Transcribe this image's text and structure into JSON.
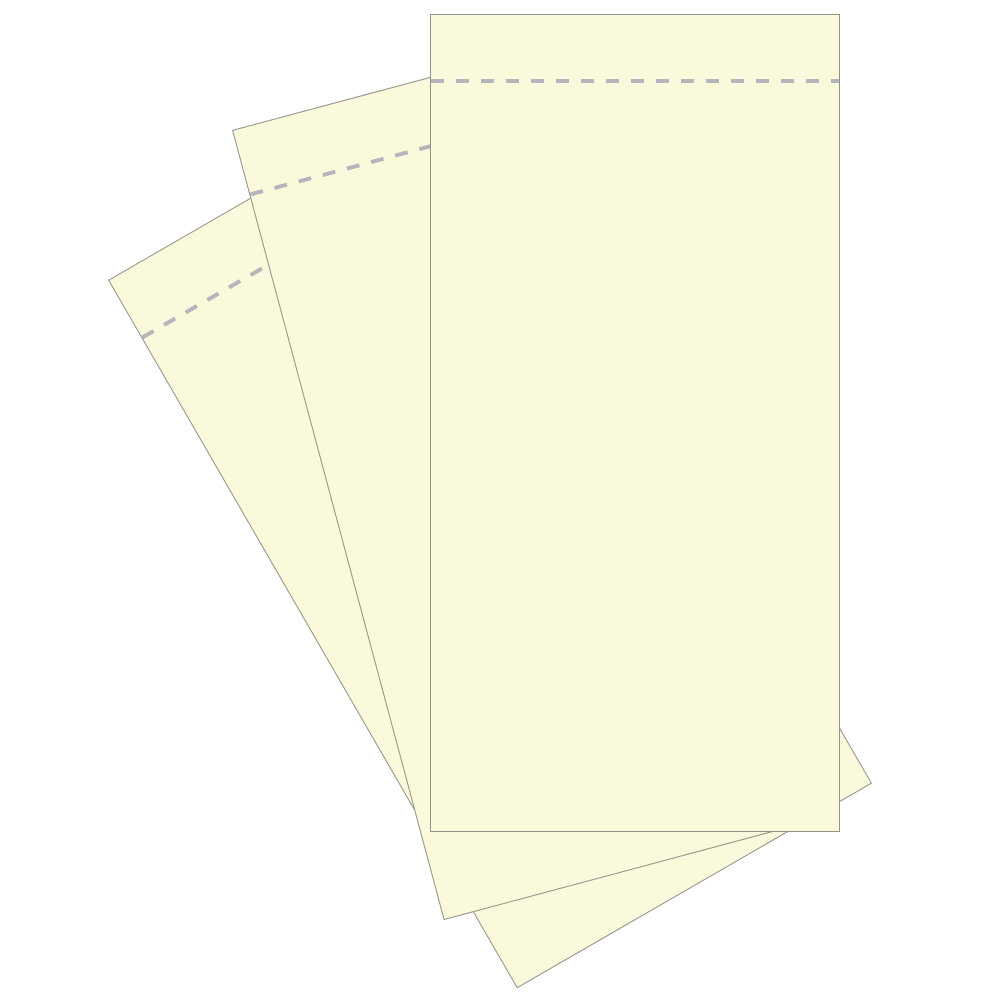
{
  "canvas": {
    "width_px": 1000,
    "height_px": 1000,
    "background_color": "#ffffff"
  },
  "paper_stack": {
    "sheet_count": 3,
    "paper_color": "#fbf9db",
    "edge_color": "#93928b",
    "perforation": {
      "color": "#b5b5bb",
      "dash_length_px": 13,
      "gap_length_px": 12,
      "thickness_px": 4,
      "offset_from_top_px": 64
    },
    "sheets": [
      {
        "name": "sheet-back",
        "x": 108,
        "y": 280,
        "width_px": 410,
        "height_px": 818,
        "rotation_deg": -30,
        "z": 1
      },
      {
        "name": "sheet-middle",
        "x": 232,
        "y": 130,
        "width_px": 410,
        "height_px": 818,
        "rotation_deg": -15,
        "z": 2
      },
      {
        "name": "sheet-front",
        "x": 430,
        "y": 14,
        "width_px": 410,
        "height_px": 818,
        "rotation_deg": 0,
        "z": 3
      }
    ]
  }
}
